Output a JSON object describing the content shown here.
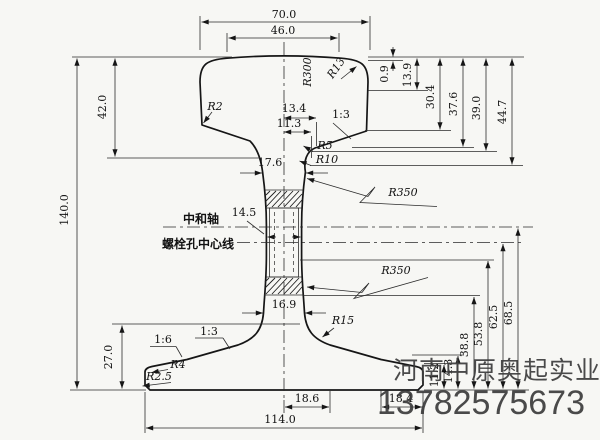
{
  "drawing": {
    "kind": "rail cross-section engineering drawing",
    "labels": {
      "neutral_axis": "中和轴",
      "bolt_centerline": "螺栓孔中心线"
    },
    "dims": {
      "head_width": "70.0",
      "head_flat": "46.0",
      "head_height": "42.0",
      "total_height": "140.0",
      "base_height": "27.0",
      "h0": "0.9",
      "h1": "13.9",
      "h2": "30.4",
      "h3": "37.6",
      "h4": "39.0",
      "h5": "44.7",
      "w1": "13.4",
      "w2": "11.3",
      "web_top": "17.6",
      "web_mid": "14.5",
      "web_bottom": "16.9",
      "v1": "68.5",
      "v2": "62.5",
      "v3": "53.8",
      "v4": "38.8",
      "v5": "14.3",
      "v6": "11.2",
      "b1": "18.6",
      "b2": "18.4",
      "base_width": "114.0"
    },
    "radii": {
      "crown": "R300",
      "head_corner": "R13",
      "head_left": "R2",
      "fillet5": "R5",
      "fillet10": "R10",
      "web_upper": "R350",
      "web_lower": "R350",
      "base_fillet": "R15",
      "base_top_corner": "R4",
      "base_bottom_corner": "R2.5"
    },
    "slopes": {
      "head_side": "1:3",
      "base_inner": "1:3",
      "base_outer": "1:6"
    },
    "watermark": {
      "line1": "河南中原奥起实业",
      "line2": "13782575673"
    }
  }
}
